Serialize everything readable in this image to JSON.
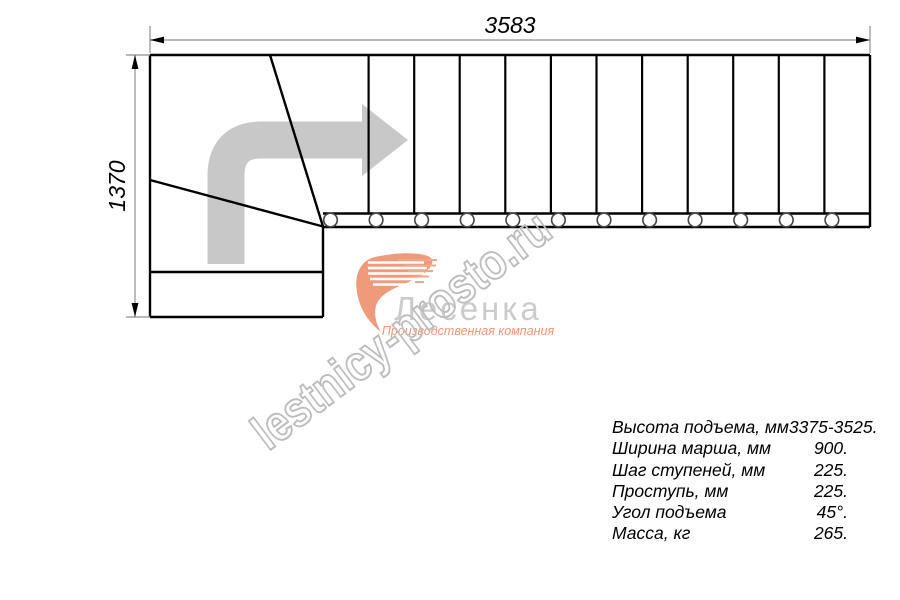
{
  "drawing": {
    "title": "stair-plan-view",
    "dimensions": {
      "width_label": "3583",
      "height_label": "1370"
    },
    "steps": {
      "straight_flight_count": 12,
      "baluster_count": 12
    },
    "specs": {
      "rows": [
        {
          "label": "Высота подъема, мм",
          "value": "3375-3525."
        },
        {
          "label": "Ширина марша, мм",
          "value": "900."
        },
        {
          "label": "Шаг ступеней, мм",
          "value": "225."
        },
        {
          "label": "Проступь, мм",
          "value": "225."
        },
        {
          "label": "Угол подъема",
          "value": "45°."
        },
        {
          "label": "Масса, кг",
          "value": "265."
        }
      ]
    }
  },
  "logo": {
    "brand": "Лесенка",
    "subtitle": "Производственная компания"
  },
  "watermark": {
    "text": "lestnicy-prosto.ru"
  },
  "colors": {
    "line_black": "#000000",
    "dimension_gray": "#8f8f8f",
    "arrow_gray": "#c8c8c8",
    "watermark_gray": "#bdbdbd",
    "logo_text_gray": "#cbcbcb",
    "brand_salmon": "#f09a7c"
  }
}
